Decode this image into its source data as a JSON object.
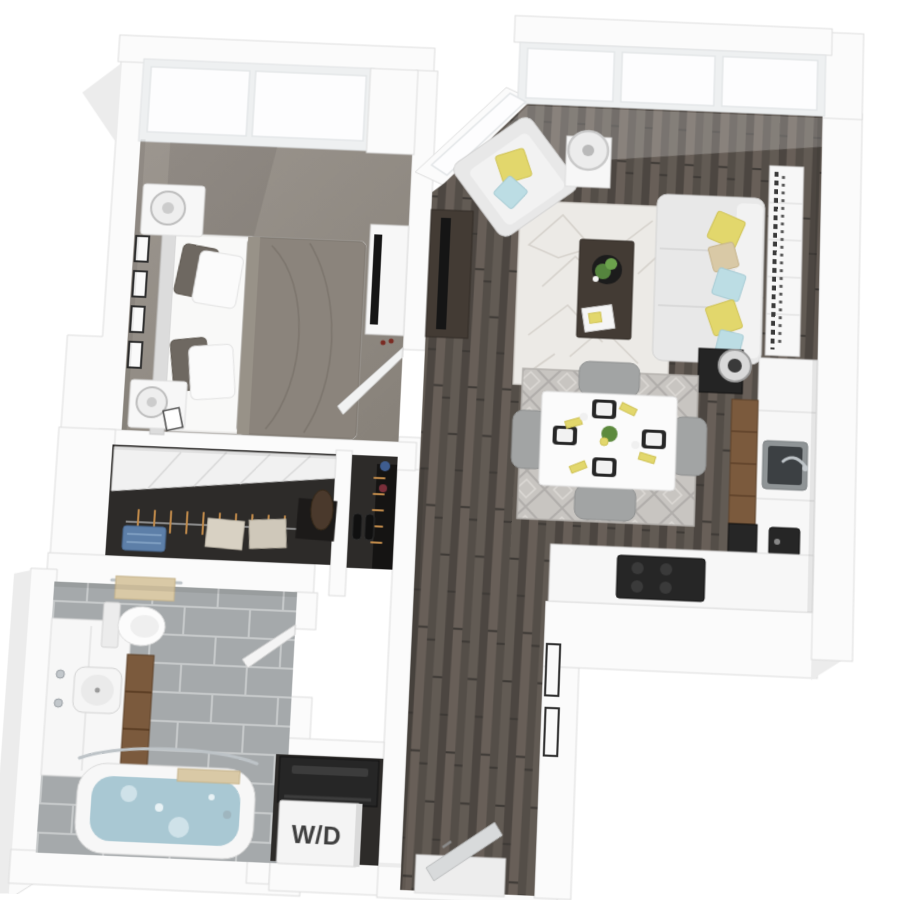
{
  "floorplan": {
    "wd_label": "W/D",
    "palette": {
      "wall": "#fbfbfb",
      "carpet": "#948e87",
      "closet_floor": "#2d2b29",
      "sofa": "#e8e8e8",
      "wood_furniture": "#433b34",
      "appliance_dark": "#262626",
      "cabinet_wood": "#7b5a3d",
      "accent_yellow": "#e2d76c",
      "accent_blue": "#bcdde4",
      "accent_tan": "#d9c9a6",
      "water": "#a9c8d3",
      "rug_light": "#eceae6"
    }
  }
}
